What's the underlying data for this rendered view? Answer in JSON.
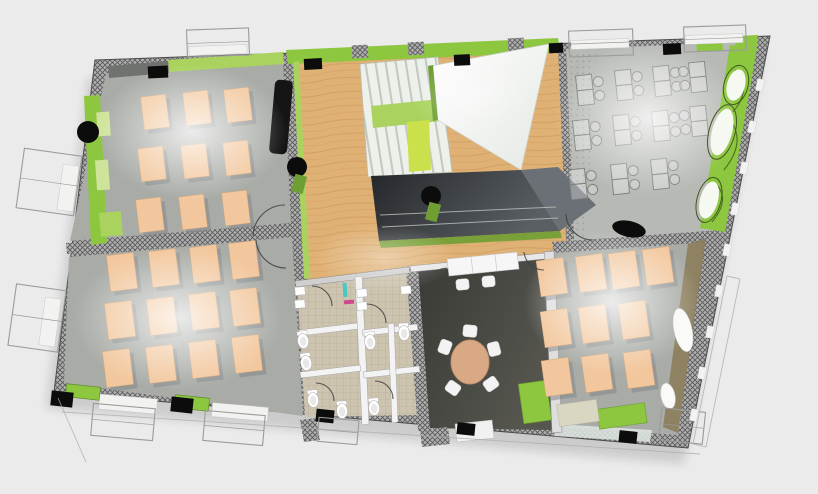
{
  "scene": {
    "title": "3D floor plan rendering",
    "view": "aerial axonometric cutaway of one building storey",
    "rooms": [
      {
        "id": "classroom-top-left",
        "name": "Classroom",
        "floor": "grey",
        "desks": 9
      },
      {
        "id": "classroom-bottom-left",
        "name": "Classroom",
        "floor": "grey",
        "desks": 12
      },
      {
        "id": "classroom-bottom-right",
        "name": "Classroom",
        "floor": "grey",
        "desks": 10
      },
      {
        "id": "office-top-right",
        "name": "Open plan office",
        "floor": "grey",
        "workstations": 11
      },
      {
        "id": "central-hall",
        "name": "Central hall",
        "floor": "wood"
      },
      {
        "id": "stairwell",
        "name": "Stairwell",
        "features": [
          "stairs",
          "skylight-glass",
          "open-void"
        ]
      },
      {
        "id": "meeting-room",
        "name": "Meeting room",
        "floor": "dark",
        "features": [
          "round-table",
          "5-chairs",
          "credenza"
        ]
      },
      {
        "id": "sanitary-block",
        "name": "Toilet block",
        "floor": "tile",
        "toilets": 7,
        "sinks": 5
      }
    ]
  },
  "palette": {
    "bg": "#ebebeb",
    "hatchBase": "#b0b0b0",
    "hatchLine": "#575757",
    "floorGray": "#a8aba6",
    "floorGrayB": "#9da09b",
    "floorOffice": "#b6b9b4",
    "desk": "#f2c79d",
    "deskShadow": "#83868a",
    "green": "#8dc63f",
    "greenLight": "#a9d35e",
    "lime": "#cbe04b",
    "greenDeep": "#6f9f33",
    "wood": "#e0b175",
    "woodLine": "#c08f52",
    "tile": "#cdc4b0",
    "tileLine": "#b3a995",
    "sill": "#f2f2f0",
    "voidA": "#26292c",
    "voidB": "#5a5f63",
    "meetA": "#3f3f3b",
    "meetB": "#55554f",
    "tableTan": "#d9a884",
    "chair": "#f3f3f3",
    "outline": "#9b9b9b",
    "wire": "#7d827d",
    "olive": "#8b7d5b",
    "black": "#0c0c0c",
    "glass": "#dfe6e2"
  },
  "furniture": {
    "classroom_desks": [
      {
        "room": "classroom-top-left",
        "w": 25,
        "h": 33,
        "rot": -7,
        "centers": [
          [
            155,
            112
          ],
          [
            197,
            108
          ],
          [
            238,
            105
          ],
          [
            152,
            164
          ],
          [
            195,
            161
          ],
          [
            237,
            158
          ],
          [
            150,
            215
          ],
          [
            193,
            212
          ],
          [
            236,
            208
          ]
        ]
      },
      {
        "room": "classroom-bottom-left",
        "w": 27,
        "h": 36,
        "rot": -7,
        "centers": [
          [
            122,
            272
          ],
          [
            164,
            268
          ],
          [
            205,
            264
          ],
          [
            244,
            260
          ],
          [
            120,
            320
          ],
          [
            162,
            316
          ],
          [
            204,
            311
          ],
          [
            245,
            307
          ],
          [
            118,
            368
          ],
          [
            161,
            364
          ],
          [
            204,
            359
          ],
          [
            247,
            354
          ]
        ]
      },
      {
        "room": "classroom-bottom-right",
        "w": 27,
        "h": 36,
        "rot": -8,
        "centers": [
          [
            552,
            277
          ],
          [
            591,
            273
          ],
          [
            624,
            270
          ],
          [
            658,
            266
          ],
          [
            556,
            328
          ],
          [
            594,
            324
          ],
          [
            634,
            320
          ],
          [
            557,
            377
          ],
          [
            597,
            373
          ],
          [
            639,
            369
          ]
        ]
      }
    ],
    "workstations": {
      "w": 16,
      "h": 30,
      "rot": -6,
      "chair_r": 5,
      "items": [
        [
          585,
          90,
          1
        ],
        [
          624,
          85,
          1
        ],
        [
          662,
          81,
          1
        ],
        [
          698,
          77,
          -1
        ],
        [
          582,
          135,
          1
        ],
        [
          622,
          130,
          1
        ],
        [
          661,
          126,
          1
        ],
        [
          699,
          121,
          -1
        ],
        [
          578,
          184,
          1
        ],
        [
          620,
          179,
          1
        ],
        [
          660,
          174,
          1
        ]
      ]
    },
    "meeting_table": {
      "x": 470,
      "y": 362,
      "rx": 19,
      "ry": 22
    },
    "meeting_chairs": [
      [
        470,
        331,
        5
      ],
      [
        494,
        349,
        75
      ],
      [
        491,
        384,
        145
      ],
      [
        453,
        388,
        215
      ],
      [
        445,
        347,
        290
      ]
    ],
    "green_benches": [
      [
        535,
        402,
        28,
        40,
        -8
      ],
      [
        622,
        416,
        48,
        20,
        -8
      ]
    ],
    "beige_box": [
      578,
      413,
      40,
      22,
      -8
    ],
    "radiators": [
      [
        83,
        392,
        34,
        13,
        6
      ],
      [
        192,
        403,
        34,
        13,
        6
      ]
    ],
    "window_sills": [
      [
        128,
        404,
        58,
        15,
        5
      ],
      [
        240,
        412,
        56,
        14,
        5
      ],
      [
        218,
        50,
        58,
        9,
        -2
      ],
      [
        600,
        44,
        58,
        9,
        -2
      ],
      [
        714,
        39,
        58,
        9,
        -2
      ],
      [
        68,
        188,
        16,
        46,
        8
      ],
      [
        50,
        322,
        16,
        48,
        8
      ]
    ]
  },
  "fixtures": {
    "toilets": [
      [
        303,
        340,
        -8
      ],
      [
        306,
        362,
        -8
      ],
      [
        313,
        399,
        -6
      ],
      [
        342,
        410,
        -4
      ],
      [
        370,
        341,
        -6
      ],
      [
        374,
        407,
        -5
      ],
      [
        404,
        332,
        -4
      ]
    ],
    "sinks": [
      [
        300,
        291
      ],
      [
        300,
        304
      ],
      [
        362,
        293
      ],
      [
        362,
        306
      ],
      [
        406,
        290
      ]
    ]
  },
  "structure": {
    "columns_round": [
      [
        88,
        132,
        11
      ],
      [
        297,
        167,
        10
      ],
      [
        431,
        196,
        10
      ]
    ],
    "column_lying": {
      "x": 629,
      "y": 229,
      "rx": 17,
      "ry": 8,
      "rot": 12
    },
    "columns_square": [
      [
        158,
        72,
        20,
        12,
        -3
      ],
      [
        313,
        64,
        18,
        11,
        -3
      ],
      [
        462,
        60,
        16,
        11,
        -3
      ],
      [
        556,
        48,
        14,
        10,
        -3
      ],
      [
        672,
        49,
        18,
        11,
        -3
      ],
      [
        62,
        399,
        22,
        15,
        6
      ],
      [
        182,
        405,
        22,
        15,
        6
      ],
      [
        325,
        416,
        18,
        13,
        6
      ],
      [
        466,
        429,
        18,
        12,
        6
      ],
      [
        628,
        437,
        18,
        12,
        6
      ]
    ],
    "windows": [
      [
        187,
        29,
        62,
        27,
        -2
      ],
      [
        569,
        30,
        64,
        26,
        -2
      ],
      [
        684,
        26,
        62,
        25,
        -2
      ],
      [
        20,
        152,
        58,
        60,
        8
      ],
      [
        12,
        287,
        50,
        62,
        8
      ],
      [
        92,
        406,
        62,
        32,
        5
      ],
      [
        204,
        413,
        60,
        30,
        5
      ],
      [
        318,
        419,
        40,
        24,
        5
      ],
      [
        660,
        410,
        44,
        32,
        6
      ]
    ],
    "right_wall_gaps": [
      [
        760,
        85
      ],
      [
        752,
        127
      ],
      [
        744,
        168
      ],
      [
        735,
        209
      ],
      [
        727,
        250
      ],
      [
        719,
        291
      ],
      [
        710,
        332
      ],
      [
        702,
        373
      ],
      [
        694,
        415
      ]
    ],
    "green_wall_ovals": [
      [
        736,
        85,
        9,
        16,
        15
      ],
      [
        722,
        132,
        10,
        24,
        15
      ],
      [
        709,
        200,
        9,
        19,
        15
      ]
    ],
    "classroom_ovals": [
      [
        683,
        330,
        9,
        22,
        -12
      ],
      [
        668,
        396,
        7,
        13,
        -12
      ]
    ]
  }
}
